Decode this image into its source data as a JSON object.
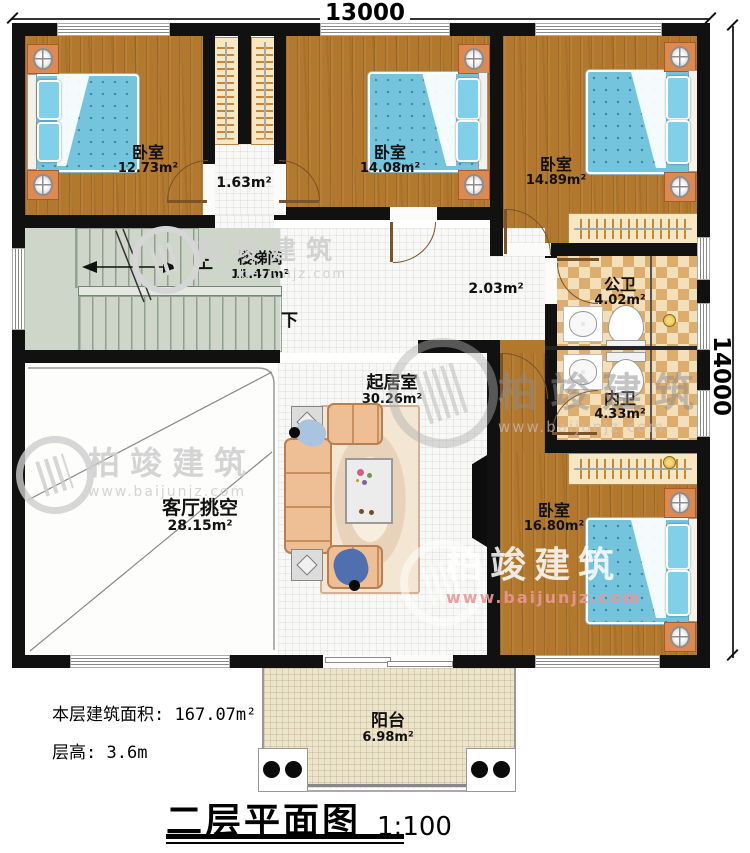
{
  "dimensions": {
    "top": "13000",
    "right": "14000"
  },
  "rooms": {
    "bedroom_tl": {
      "name": "卧室",
      "area": "12.73m²"
    },
    "closet": {
      "area": "1.63m²"
    },
    "bedroom_tm": {
      "name": "卧室",
      "area": "14.08m²"
    },
    "bedroom_tr": {
      "name": "卧室",
      "area": "14.89m²"
    },
    "stairwell": {
      "name": "楼梯间",
      "area": "11.47m²",
      "up": "上",
      "down": "下"
    },
    "hallway": {
      "area": "2.03m²"
    },
    "public_bath": {
      "name": "公卫",
      "area": "4.02m²"
    },
    "private_bath": {
      "name": "内卫",
      "area": "4.33m²"
    },
    "living": {
      "name": "起居室",
      "area": "30.26m²"
    },
    "void": {
      "name": "客厅挑空",
      "area": "28.15m²"
    },
    "bedroom_br": {
      "name": "卧室",
      "area": "16.80m²"
    },
    "balcony": {
      "name": "阳台",
      "area": "6.98m²"
    }
  },
  "footer": {
    "area_label": "本层建筑面积:",
    "area_value": "167.07m²",
    "height_label": "层高:",
    "height_value": "3.6m"
  },
  "title": {
    "name": "二层平面图",
    "scale": "1:100"
  },
  "watermark": {
    "brand": "柏竣建筑",
    "url": "www.baijunjz.com"
  },
  "colors": {
    "wall": "#111111",
    "wood_floor": "#b1782e",
    "bed_blue": "#74c4dd",
    "checker_tan": "#ddad6d",
    "stair_green": "#cdd6c8",
    "balcony_cream": "#ece4cb",
    "nightstand_orange": "#dd8a52",
    "watermark_gray": "#cccccc",
    "watermark_url_red": "#e49a9a"
  }
}
